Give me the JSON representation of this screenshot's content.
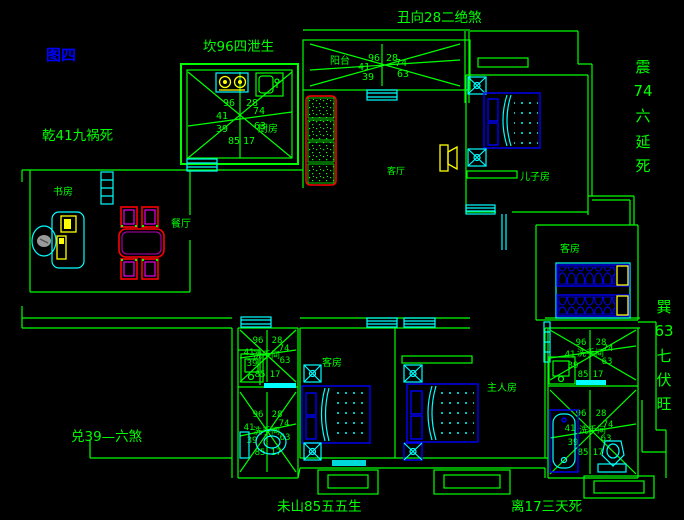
{
  "figure_label": "图四",
  "annotations": {
    "top_center": "丑向28二绝煞",
    "kitchen_outside": "坎96四泄生",
    "northwest": "乾41九祸死",
    "west": "兑39—六煞",
    "south_left": "未山85五五生",
    "south_right": "离17三天死",
    "east_upper": {
      "l1": "震",
      "l2": "74",
      "l3": "六",
      "l4": "延",
      "l5": "死"
    },
    "east_lower": {
      "l1": "巽",
      "l2": "63",
      "l3": "七",
      "l4": "伏",
      "l5": "旺"
    }
  },
  "rooms": {
    "kitchen": "厨房",
    "balcony": "阳台",
    "living": "客厅",
    "study": "书房",
    "dining": "餐厅",
    "son": "儿子房",
    "guest_east": "客房",
    "guest_south": "客房",
    "master": "主人房",
    "bath": "洗手间"
  },
  "star": {
    "tl": "96",
    "tr": "28",
    "l": "41",
    "r": "74",
    "bl": "39",
    "br": "63",
    "b1": "85",
    "b2": "17"
  },
  "colors": {
    "background": "#000000",
    "wall_line": "#00ff00",
    "fixture_cyan": "#00ffff",
    "furniture_blue": "#0000ff",
    "highlight_yellow": "#ffff00",
    "dining_red": "#ff0000",
    "dining_magenta": "#ff00ff",
    "figure_label_blue": "#0000ff"
  }
}
